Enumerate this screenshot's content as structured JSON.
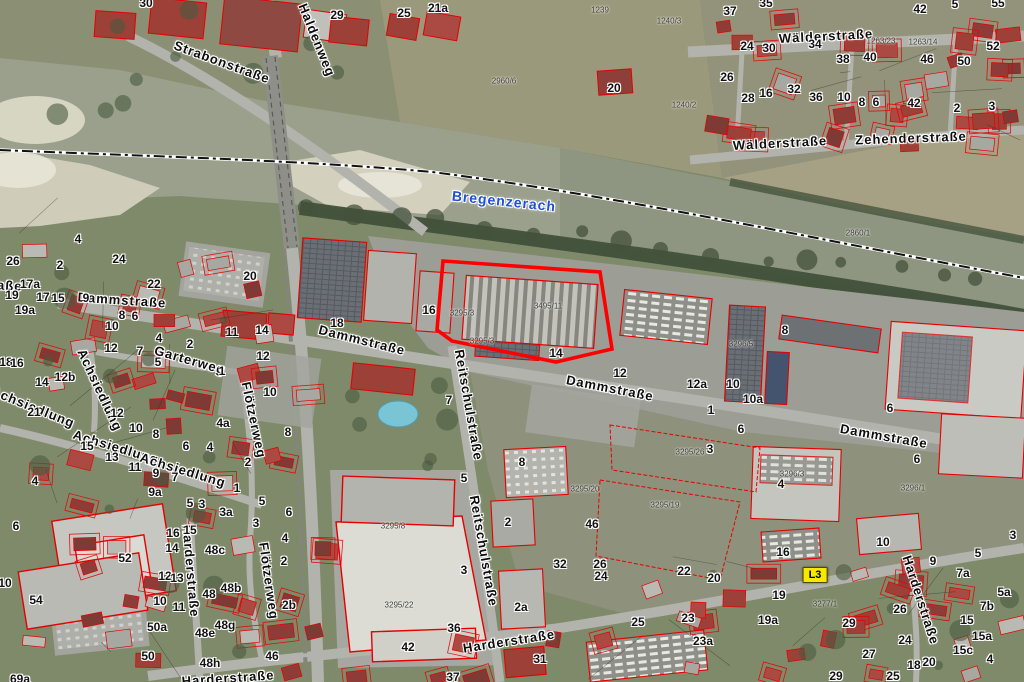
{
  "map": {
    "title": "Orthophoto cadastral map",
    "colors": {
      "water": "#9aa08c",
      "water_dark": "#8d9480",
      "sand": "#d3d0bd",
      "ground": "#7f8a6a",
      "road": "#b2b3ac",
      "industrial": "#9c9e96",
      "outline_red": "#e60000",
      "highlight_red": "#ff0000",
      "roof_red": "#9c4038",
      "roof_gray": "#bfc0ba",
      "river_label_blue": "#2050d0",
      "marker_yellow": "#f7e800"
    },
    "labels": {
      "river": {
        "t": "Bregenzerach",
        "x": 504,
        "y": 201,
        "r": 6
      },
      "marker": {
        "t": "L3",
        "x": 815,
        "y": 575
      },
      "streets": [
        {
          "t": "Strabonstraße",
          "x": 222,
          "y": 62,
          "r": 20
        },
        {
          "t": "Haldenweg",
          "x": 317,
          "y": 40,
          "r": 68
        },
        {
          "t": "Wälderstraße",
          "x": 826,
          "y": 36,
          "r": -3
        },
        {
          "t": "Wälderstraße",
          "x": 780,
          "y": 143,
          "r": -3
        },
        {
          "t": "Zehenderstraße",
          "x": 911,
          "y": 138,
          "r": -2
        },
        {
          "t": "straße",
          "x": 0,
          "y": 285,
          "r": 3
        },
        {
          "t": "Dammstraße",
          "x": 122,
          "y": 300,
          "r": 4
        },
        {
          "t": "Dammstraße",
          "x": 362,
          "y": 340,
          "r": 14
        },
        {
          "t": "Dammstraße",
          "x": 610,
          "y": 388,
          "r": 11
        },
        {
          "t": "Dammstraße",
          "x": 884,
          "y": 436,
          "r": 10
        },
        {
          "t": "Achsiedlung",
          "x": 33,
          "y": 407,
          "r": 22
        },
        {
          "t": "Achsiedlung",
          "x": 100,
          "y": 390,
          "r": 65
        },
        {
          "t": "Achsiedlung",
          "x": 116,
          "y": 447,
          "r": 17
        },
        {
          "t": "Achsiedlung",
          "x": 183,
          "y": 470,
          "r": 17
        },
        {
          "t": "Garterweg",
          "x": 190,
          "y": 360,
          "r": 16
        },
        {
          "t": "Flötzerweg",
          "x": 254,
          "y": 420,
          "r": 78
        },
        {
          "t": "Flötzerweg",
          "x": 269,
          "y": 581,
          "r": 82
        },
        {
          "t": "Reitschulstraße",
          "x": 469,
          "y": 405,
          "r": 80
        },
        {
          "t": "Reitschulstraße",
          "x": 484,
          "y": 551,
          "r": 80
        },
        {
          "t": "Harderstraße",
          "x": 509,
          "y": 641,
          "r": -9
        },
        {
          "t": "Harderstraße",
          "x": 191,
          "y": 571,
          "r": 85
        },
        {
          "t": "Harderstraße",
          "x": 228,
          "y": 678,
          "r": -4
        },
        {
          "t": "Harderstraße",
          "x": 921,
          "y": 600,
          "r": 72
        }
      ],
      "house_numbers": [
        {
          "t": "30",
          "x": 146,
          "y": 3
        },
        {
          "t": "29",
          "x": 337,
          "y": 15
        },
        {
          "t": "25",
          "x": 404,
          "y": 13
        },
        {
          "t": "21a",
          "x": 438,
          "y": 8
        },
        {
          "t": "20",
          "x": 614,
          "y": 88
        },
        {
          "t": "37",
          "x": 730,
          "y": 11
        },
        {
          "t": "35",
          "x": 766,
          "y": 3
        },
        {
          "t": "42",
          "x": 920,
          "y": 9
        },
        {
          "t": "5",
          "x": 955,
          "y": 4
        },
        {
          "t": "55",
          "x": 998,
          "y": 3
        },
        {
          "t": "24",
          "x": 747,
          "y": 46
        },
        {
          "t": "30",
          "x": 769,
          "y": 48
        },
        {
          "t": "34",
          "x": 815,
          "y": 44
        },
        {
          "t": "38",
          "x": 843,
          "y": 59
        },
        {
          "t": "40",
          "x": 870,
          "y": 57
        },
        {
          "t": "46",
          "x": 927,
          "y": 59
        },
        {
          "t": "50",
          "x": 964,
          "y": 61
        },
        {
          "t": "52",
          "x": 993,
          "y": 46
        },
        {
          "t": "26",
          "x": 727,
          "y": 77
        },
        {
          "t": "28",
          "x": 748,
          "y": 98
        },
        {
          "t": "16",
          "x": 766,
          "y": 93
        },
        {
          "t": "32",
          "x": 794,
          "y": 89
        },
        {
          "t": "36",
          "x": 816,
          "y": 97
        },
        {
          "t": "10",
          "x": 844,
          "y": 97
        },
        {
          "t": "8",
          "x": 862,
          "y": 102
        },
        {
          "t": "6",
          "x": 876,
          "y": 102
        },
        {
          "t": "42",
          "x": 914,
          "y": 103
        },
        {
          "t": "2",
          "x": 957,
          "y": 108
        },
        {
          "t": "3",
          "x": 992,
          "y": 106
        },
        {
          "t": "26",
          "x": 13,
          "y": 261
        },
        {
          "t": "2",
          "x": 60,
          "y": 265
        },
        {
          "t": "24",
          "x": 119,
          "y": 259
        },
        {
          "t": "4",
          "x": 78,
          "y": 239
        },
        {
          "t": "22",
          "x": 154,
          "y": 284
        },
        {
          "t": "20",
          "x": 250,
          "y": 276
        },
        {
          "t": "18",
          "x": 337,
          "y": 323
        },
        {
          "t": "17a",
          "x": 30,
          "y": 284
        },
        {
          "t": "19",
          "x": 12,
          "y": 295
        },
        {
          "t": "17",
          "x": 43,
          "y": 297
        },
        {
          "t": "15",
          "x": 58,
          "y": 298
        },
        {
          "t": "9",
          "x": 86,
          "y": 298
        },
        {
          "t": "19a",
          "x": 25,
          "y": 310
        },
        {
          "t": "8",
          "x": 122,
          "y": 315
        },
        {
          "t": "6",
          "x": 135,
          "y": 316
        },
        {
          "t": "10",
          "x": 112,
          "y": 326
        },
        {
          "t": "11",
          "x": 232,
          "y": 332
        },
        {
          "t": "14",
          "x": 262,
          "y": 330
        },
        {
          "t": "12",
          "x": 111,
          "y": 348
        },
        {
          "t": "7",
          "x": 140,
          "y": 351
        },
        {
          "t": "4",
          "x": 159,
          "y": 338
        },
        {
          "t": "2",
          "x": 190,
          "y": 344
        },
        {
          "t": "5",
          "x": 158,
          "y": 362
        },
        {
          "t": "1",
          "x": 222,
          "y": 371
        },
        {
          "t": "12",
          "x": 263,
          "y": 356
        },
        {
          "t": "18",
          "x": 6,
          "y": 362
        },
        {
          "t": "16",
          "x": 17,
          "y": 363
        },
        {
          "t": "14",
          "x": 42,
          "y": 382
        },
        {
          "t": "12b",
          "x": 65,
          "y": 377
        },
        {
          "t": "21",
          "x": 34,
          "y": 412
        },
        {
          "t": "12",
          "x": 117,
          "y": 413
        },
        {
          "t": "10",
          "x": 136,
          "y": 428
        },
        {
          "t": "8",
          "x": 156,
          "y": 434
        },
        {
          "t": "4a",
          "x": 223,
          "y": 423
        },
        {
          "t": "6",
          "x": 186,
          "y": 446
        },
        {
          "t": "4",
          "x": 210,
          "y": 447
        },
        {
          "t": "2",
          "x": 248,
          "y": 462
        },
        {
          "t": "15",
          "x": 87,
          "y": 446
        },
        {
          "t": "13",
          "x": 112,
          "y": 457
        },
        {
          "t": "11",
          "x": 135,
          "y": 467
        },
        {
          "t": "9",
          "x": 156,
          "y": 473
        },
        {
          "t": "7",
          "x": 175,
          "y": 477
        },
        {
          "t": "9a",
          "x": 155,
          "y": 492
        },
        {
          "t": "4",
          "x": 35,
          "y": 481
        },
        {
          "t": "10",
          "x": 270,
          "y": 392
        },
        {
          "t": "8",
          "x": 288,
          "y": 432
        },
        {
          "t": "2",
          "x": 284,
          "y": 561
        },
        {
          "t": "6",
          "x": 16,
          "y": 526
        },
        {
          "t": "52",
          "x": 125,
          "y": 558
        },
        {
          "t": "54",
          "x": 36,
          "y": 600
        },
        {
          "t": "10",
          "x": 5,
          "y": 583
        },
        {
          "t": "16",
          "x": 173,
          "y": 533
        },
        {
          "t": "15",
          "x": 190,
          "y": 530
        },
        {
          "t": "14",
          "x": 172,
          "y": 548
        },
        {
          "t": "48c",
          "x": 215,
          "y": 550
        },
        {
          "t": "12",
          "x": 165,
          "y": 576
        },
        {
          "t": "13",
          "x": 177,
          "y": 578
        },
        {
          "t": "48",
          "x": 209,
          "y": 594
        },
        {
          "t": "48b",
          "x": 231,
          "y": 588
        },
        {
          "t": "10",
          "x": 160,
          "y": 601
        },
        {
          "t": "11",
          "x": 179,
          "y": 607
        },
        {
          "t": "48g",
          "x": 225,
          "y": 625
        },
        {
          "t": "48e",
          "x": 205,
          "y": 633
        },
        {
          "t": "50a",
          "x": 157,
          "y": 627
        },
        {
          "t": "50",
          "x": 148,
          "y": 656
        },
        {
          "t": "48h",
          "x": 210,
          "y": 663
        },
        {
          "t": "46",
          "x": 272,
          "y": 656
        },
        {
          "t": "2b",
          "x": 289,
          "y": 605
        },
        {
          "t": "69a",
          "x": 20,
          "y": 679
        },
        {
          "t": "3a",
          "x": 226,
          "y": 512
        },
        {
          "t": "3",
          "x": 256,
          "y": 523
        },
        {
          "t": "6",
          "x": 289,
          "y": 512
        },
        {
          "t": "4",
          "x": 285,
          "y": 538
        },
        {
          "t": "5",
          "x": 190,
          "y": 503
        },
        {
          "t": "3",
          "x": 202,
          "y": 504
        },
        {
          "t": "1",
          "x": 237,
          "y": 488
        },
        {
          "t": "5",
          "x": 262,
          "y": 501
        },
        {
          "t": "16",
          "x": 429,
          "y": 310
        },
        {
          "t": "14",
          "x": 556,
          "y": 353
        },
        {
          "t": "12",
          "x": 620,
          "y": 373
        },
        {
          "t": "7",
          "x": 449,
          "y": 400
        },
        {
          "t": "8",
          "x": 785,
          "y": 330
        },
        {
          "t": "12a",
          "x": 697,
          "y": 384
        },
        {
          "t": "10",
          "x": 733,
          "y": 384
        },
        {
          "t": "10a",
          "x": 753,
          "y": 399
        },
        {
          "t": "1",
          "x": 711,
          "y": 410
        },
        {
          "t": "6",
          "x": 741,
          "y": 429
        },
        {
          "t": "3",
          "x": 710,
          "y": 449
        },
        {
          "t": "6",
          "x": 890,
          "y": 408
        },
        {
          "t": "6",
          "x": 917,
          "y": 459
        },
        {
          "t": "4",
          "x": 781,
          "y": 484
        },
        {
          "t": "10",
          "x": 883,
          "y": 542
        },
        {
          "t": "5",
          "x": 464,
          "y": 478
        },
        {
          "t": "8",
          "x": 522,
          "y": 462
        },
        {
          "t": "2",
          "x": 508,
          "y": 522
        },
        {
          "t": "3",
          "x": 464,
          "y": 570
        },
        {
          "t": "2a",
          "x": 521,
          "y": 607
        },
        {
          "t": "36",
          "x": 454,
          "y": 628
        },
        {
          "t": "42",
          "x": 408,
          "y": 647
        },
        {
          "t": "46",
          "x": 592,
          "y": 524
        },
        {
          "t": "32",
          "x": 560,
          "y": 564
        },
        {
          "t": "26",
          "x": 600,
          "y": 564
        },
        {
          "t": "24",
          "x": 601,
          "y": 576
        },
        {
          "t": "25",
          "x": 638,
          "y": 622
        },
        {
          "t": "31",
          "x": 540,
          "y": 659
        },
        {
          "t": "37",
          "x": 453,
          "y": 677
        },
        {
          "t": "16",
          "x": 783,
          "y": 552
        },
        {
          "t": "20",
          "x": 714,
          "y": 578
        },
        {
          "t": "22",
          "x": 684,
          "y": 571
        },
        {
          "t": "19",
          "x": 779,
          "y": 595
        },
        {
          "t": "19a",
          "x": 768,
          "y": 620
        },
        {
          "t": "23",
          "x": 688,
          "y": 618
        },
        {
          "t": "23a",
          "x": 703,
          "y": 641
        },
        {
          "t": "29",
          "x": 849,
          "y": 623
        },
        {
          "t": "26",
          "x": 900,
          "y": 609
        },
        {
          "t": "24",
          "x": 905,
          "y": 640
        },
        {
          "t": "27",
          "x": 869,
          "y": 654
        },
        {
          "t": "18",
          "x": 914,
          "y": 665
        },
        {
          "t": "20",
          "x": 929,
          "y": 662
        },
        {
          "t": "25",
          "x": 893,
          "y": 676
        },
        {
          "t": "29",
          "x": 836,
          "y": 676
        },
        {
          "t": "9",
          "x": 933,
          "y": 561
        },
        {
          "t": "5",
          "x": 978,
          "y": 553
        },
        {
          "t": "7a",
          "x": 963,
          "y": 573
        },
        {
          "t": "5a",
          "x": 1004,
          "y": 592
        },
        {
          "t": "7b",
          "x": 987,
          "y": 606
        },
        {
          "t": "15",
          "x": 967,
          "y": 620
        },
        {
          "t": "15a",
          "x": 982,
          "y": 636
        },
        {
          "t": "15c",
          "x": 963,
          "y": 650
        },
        {
          "t": "4",
          "x": 990,
          "y": 659
        },
        {
          "t": "3",
          "x": 1013,
          "y": 535
        }
      ],
      "parcel_numbers": [
        {
          "t": "1239",
          "x": 600,
          "y": 10
        },
        {
          "t": "1240/3",
          "x": 669,
          "y": 21
        },
        {
          "t": "1240/2",
          "x": 684,
          "y": 105
        },
        {
          "t": "2960/6",
          "x": 504,
          "y": 81
        },
        {
          "t": "1263/23",
          "x": 881,
          "y": 41
        },
        {
          "t": "1263/14",
          "x": 923,
          "y": 42
        },
        {
          "t": "2860/1",
          "x": 858,
          "y": 233
        },
        {
          "t": "3295/3",
          "x": 462,
          "y": 313
        },
        {
          "t": "3295/3",
          "x": 482,
          "y": 341
        },
        {
          "t": "3495/11",
          "x": 548,
          "y": 306
        },
        {
          "t": "3296/5",
          "x": 741,
          "y": 344
        },
        {
          "t": "3296/3",
          "x": 792,
          "y": 474
        },
        {
          "t": "3296/1",
          "x": 913,
          "y": 488
        },
        {
          "t": "3295/26",
          "x": 690,
          "y": 452
        },
        {
          "t": "3295/19",
          "x": 665,
          "y": 505
        },
        {
          "t": "3295/20",
          "x": 585,
          "y": 489
        },
        {
          "t": "3295/8",
          "x": 393,
          "y": 526
        },
        {
          "t": "3295/22",
          "x": 399,
          "y": 605
        },
        {
          "t": "3277/1",
          "x": 825,
          "y": 604
        }
      ]
    }
  }
}
